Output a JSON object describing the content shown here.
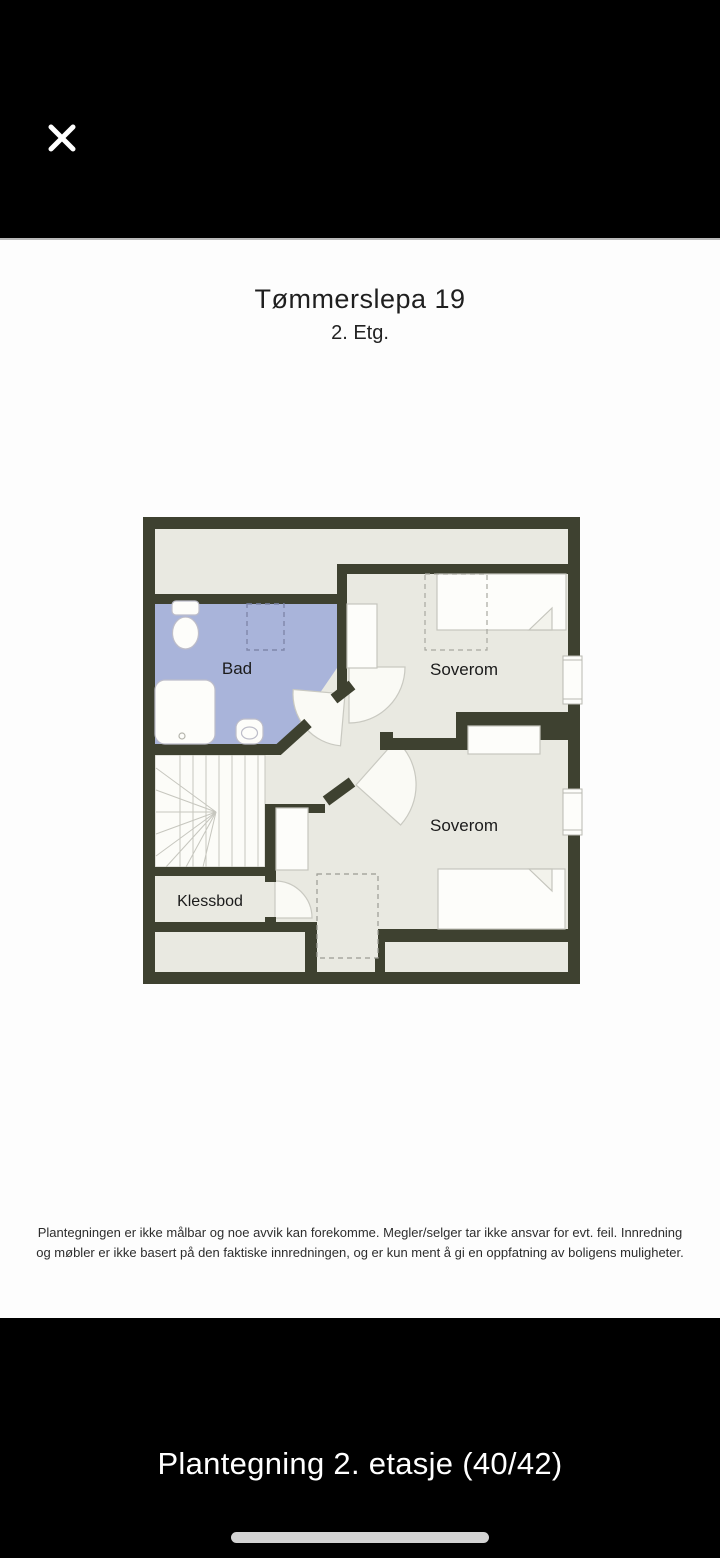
{
  "top_bar": {
    "close_icon": "close-x"
  },
  "floorplan": {
    "title": "Tømmerslepa 19",
    "subtitle": "2. Etg.",
    "rooms": {
      "bathroom": "Bad",
      "bedroom_top": "Soverom",
      "bedroom_bottom": "Soverom",
      "closet": "Klessbod"
    },
    "colors": {
      "wall": "#3e4130",
      "floor": "#e9e9e1",
      "bathroom_floor": "#a9b4da",
      "furniture_outline": "#c5c5bd",
      "stairs_fill": "#fcfcf8"
    }
  },
  "disclaimer": {
    "line1": "Plantegningen er ikke målbar og noe avvik kan forekomme. Megler/selger tar ikke ansvar for evt. feil. Innredning",
    "line2": "og møbler er ikke basert på den faktiske innredningen, og er kun ment å gi en oppfatning av boligens muligheter."
  },
  "bottom_bar": {
    "caption": "Plantegning 2. etasje (40/42)",
    "photo_index": "40",
    "photo_total": "42"
  },
  "page": {
    "background": "#000000",
    "image_background": "#fdfdfd",
    "caption_text": "#ffffff",
    "home_indicator": "#d3d3d3"
  }
}
